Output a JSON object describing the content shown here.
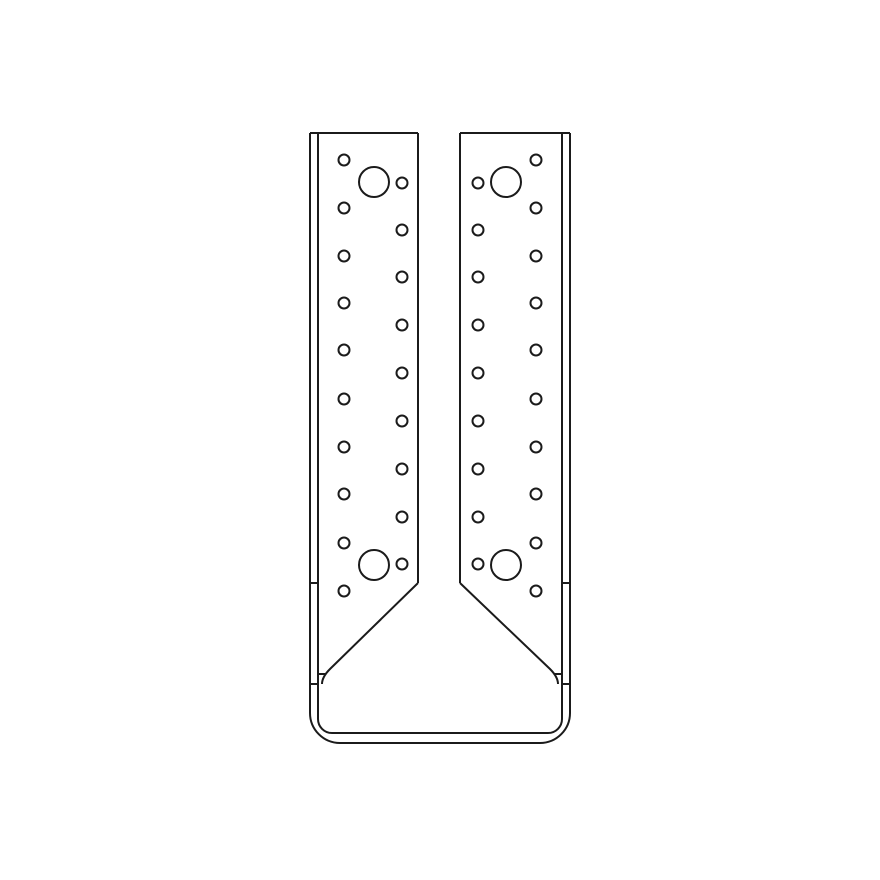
{
  "canvas": {
    "width": 880,
    "height": 880,
    "background": "#ffffff"
  },
  "diagram": {
    "name": "joist-hanger-technical-drawing",
    "viewbox": "0 0 880 880",
    "line_color": "#1b1b1b",
    "line_width": 2,
    "fill": "none",
    "outline_paths": [
      {
        "name": "outer-contour",
        "d": "M 310,133 L 310,713 A 30,30 0 0 0 340,743 L 540,743 A 30,30 0 0 0 570,713 L 570,133"
      },
      {
        "name": "inner-thickness-contour",
        "d": "M 318,133 L 318,719 A 14,14 0 0 0 332,733 L 548,733 A 14,14 0 0 0 562,719 L 562,133"
      },
      {
        "name": "left-flange-top-edge",
        "d": "M 310,133 L 418,133"
      },
      {
        "name": "right-flange-top-edge",
        "d": "M 460,133 L 570,133"
      },
      {
        "name": "left-flange-inner-edge",
        "d": "M 418,133 L 418,583"
      },
      {
        "name": "right-flange-inner-edge",
        "d": "M 460,133 L 460,583"
      },
      {
        "name": "left-gusset-fold-edge",
        "d": "M 418,583 L 330,669 Q 322,677 322,684"
      },
      {
        "name": "right-gusset-fold-edge",
        "d": "M 460,583 L 550,669 Q 558,677 558,684"
      },
      {
        "name": "left-edge-tick-upper",
        "d": "M 310,583 L 318,583"
      },
      {
        "name": "left-edge-tick-middle",
        "d": "M 318,674 L 326,674"
      },
      {
        "name": "left-edge-tick-lower",
        "d": "M 310,684 L 318,684"
      },
      {
        "name": "right-edge-tick-upper",
        "d": "M 562,583 L 570,583"
      },
      {
        "name": "right-edge-tick-middle",
        "d": "M 554,674 L 562,674"
      },
      {
        "name": "right-edge-tick-lower",
        "d": "M 562,684 L 570,684"
      }
    ],
    "small_hole_radius": 5.5,
    "large_hole_radius": 15,
    "hole_columns": [
      {
        "name": "left-flange-outer-hole-column",
        "x": 344,
        "ys": [
          160,
          208,
          256,
          303,
          350,
          399,
          447,
          494,
          543,
          591
        ]
      },
      {
        "name": "left-flange-inner-hole-column",
        "x": 402,
        "ys": [
          183,
          230,
          277,
          325,
          373,
          421,
          469,
          517,
          564
        ]
      },
      {
        "name": "right-flange-inner-hole-column",
        "x": 478,
        "ys": [
          183,
          230,
          277,
          325,
          373,
          421,
          469,
          517,
          564
        ]
      },
      {
        "name": "right-flange-outer-hole-column",
        "x": 536,
        "ys": [
          160,
          208,
          256,
          303,
          350,
          399,
          447,
          494,
          543,
          591
        ]
      }
    ],
    "large_holes": [
      {
        "name": "left-flange-top-large-hole",
        "cx": 374,
        "cy": 182
      },
      {
        "name": "left-flange-bottom-large-hole",
        "cx": 374,
        "cy": 565
      },
      {
        "name": "right-flange-top-large-hole",
        "cx": 506,
        "cy": 182
      },
      {
        "name": "right-flange-bottom-large-hole",
        "cx": 506,
        "cy": 565
      }
    ]
  }
}
